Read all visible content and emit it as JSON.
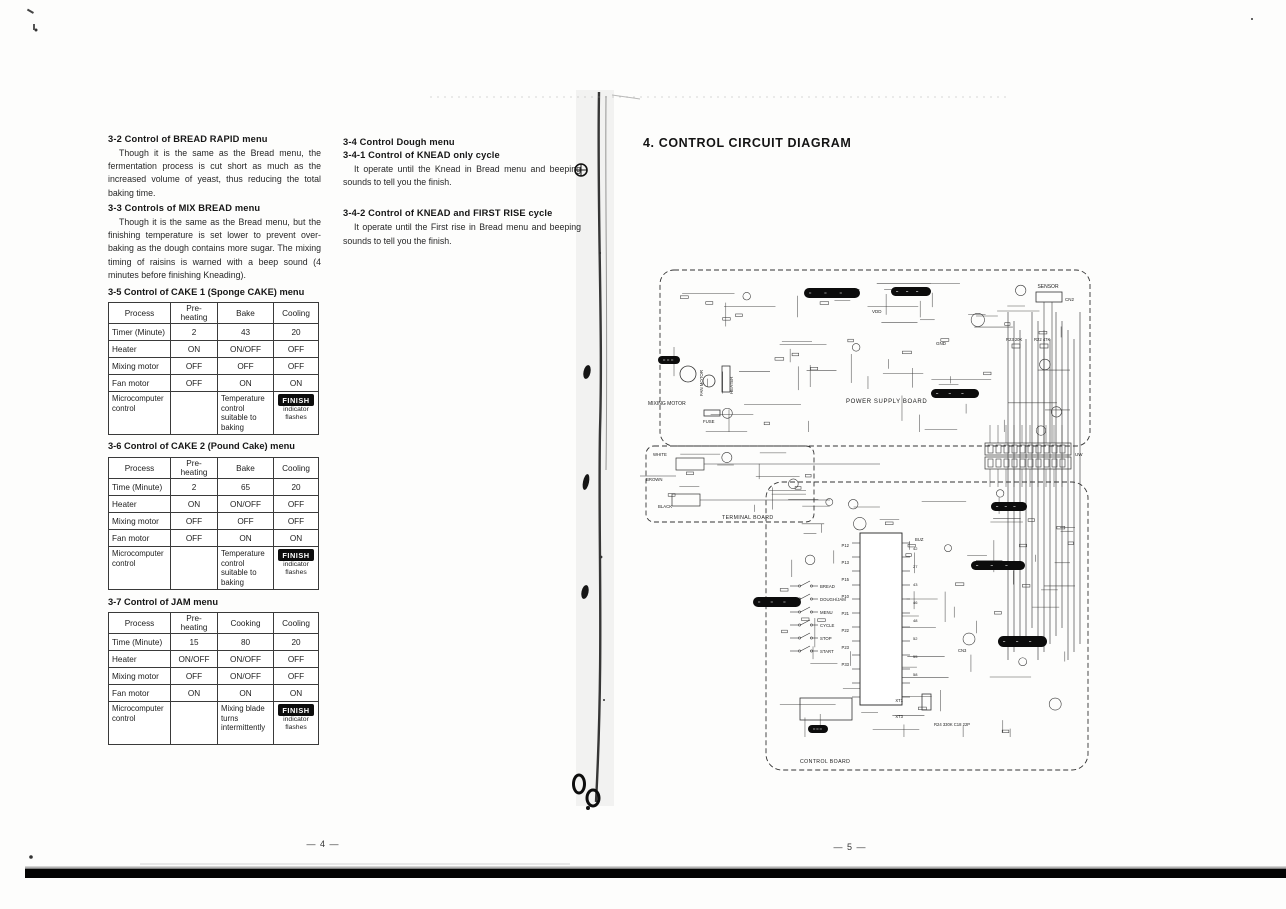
{
  "scan": {
    "page_left_number": "— 4 —",
    "page_right_number": "— 5 —"
  },
  "left": {
    "sections": [
      {
        "heading": "3-2   Control of BREAD RAPID menu",
        "body": "Though it is the same as the Bread menu, the fermentation process is cut short as much as the increased volume of yeast, thus reducing the total baking time."
      },
      {
        "heading": "3-3   Controls of MIX BREAD menu",
        "body": "Though it is the same as the Bread menu, but the finishing temperature is set lower to prevent over-baking as the dough contains more sugar. The mixing timing of raisins is warned with a beep sound (4 minutes before finishing Kneading)."
      }
    ],
    "dough": {
      "heading": "3-4   Control Dough menu",
      "sub1": "3-4-1   Control of KNEAD only cycle",
      "body1": "It operate until the Knead in Bread menu and beeping sounds to tell you the finish.",
      "sub2": "3-4-2   Control of KNEAD and FIRST RISE cycle",
      "body2": "It operate until the First rise in Bread menu and beeping sounds to tell you the finish."
    },
    "tables": [
      {
        "heading": "3-5   Control of CAKE 1 (Sponge CAKE) menu",
        "columns": [
          "Process",
          "Pre-heating",
          "Bake",
          "Cooling"
        ],
        "rows": [
          [
            "Timer (Minute)",
            "2",
            "43",
            "20"
          ],
          [
            "Heater",
            "ON",
            "ON/OFF",
            "OFF"
          ],
          [
            "Mixing motor",
            "OFF",
            "OFF",
            "OFF"
          ],
          [
            "Fan motor",
            "OFF",
            "ON",
            "ON"
          ]
        ],
        "footer": {
          "label": "Microcomputer control",
          "pre": "",
          "note": "Temperature control suitable to baking",
          "finish": "FINISH",
          "finish_note_1": "indicator",
          "finish_note_2": "flashes"
        }
      },
      {
        "heading": "3-6   Control of CAKE 2 (Pound Cake) menu",
        "columns": [
          "Process",
          "Pre-heating",
          "Bake",
          "Cooling"
        ],
        "rows": [
          [
            "Time (Minute)",
            "2",
            "65",
            "20"
          ],
          [
            "Heater",
            "ON",
            "ON/OFF",
            "OFF"
          ],
          [
            "Mixing motor",
            "OFF",
            "OFF",
            "OFF"
          ],
          [
            "Fan motor",
            "OFF",
            "ON",
            "ON"
          ]
        ],
        "footer": {
          "label": "Microcomputer control",
          "pre": "",
          "note": "Temperature control suitable to baking",
          "finish": "FINISH",
          "finish_note_1": "indicator",
          "finish_note_2": "flashes"
        }
      },
      {
        "heading": "3-7   Control of JAM menu",
        "columns": [
          "Process",
          "Pre-heating",
          "Cooking",
          "Cooling"
        ],
        "rows": [
          [
            "Time (Minute)",
            "15",
            "80",
            "20"
          ],
          [
            "Heater",
            "ON/OFF",
            "ON/OFF",
            "OFF"
          ],
          [
            "Mixing motor",
            "OFF",
            "ON/OFF",
            "OFF"
          ],
          [
            "Fan motor",
            "ON",
            "ON",
            "ON"
          ]
        ],
        "footer": {
          "label": "Microcomputer control",
          "pre": "",
          "note": "Mixing blade turns intermittently",
          "finish": "FINISH",
          "finish_note_1": "indicator",
          "finish_note_2": "flashes"
        }
      }
    ]
  },
  "right": {
    "title": "4.  CONTROL CIRCUIT DIAGRAM",
    "diagram": {
      "boards": {
        "power": "POWER SUPPLY BOARD",
        "terminal": "TERMINAL BOARD",
        "control": "CONTROL BOARD"
      },
      "labels": {
        "sensor": "SENSOR",
        "cn2": "CN2",
        "cn3": "CN3",
        "uw": "UW",
        "vdd": "VDD",
        "gnd": "GND",
        "buz": "BUZ",
        "white": "WHITE",
        "brown": "BROWN",
        "black": "BLACK",
        "mixing_motor": "MIXING MOTOR",
        "fan_motor": "FAN MOTOR",
        "heater": "HEATER",
        "fuse": "FUSE",
        "r23": "R23 20K",
        "r22": "R22 47K",
        "r24": "R24 330K  C18 22P",
        "xt1": "XT1",
        "xt3": "XT3"
      },
      "switch_labels": [
        "BREAD",
        "DOUGH/JAM",
        "MENU",
        "CYCLE",
        "STOP",
        "START"
      ],
      "ic_ports_left": [
        "P12",
        "P13",
        "P15",
        "P10",
        "P21",
        "P22",
        "P23",
        "P33"
      ],
      "ic_pins_right": [
        "42",
        "27",
        "43",
        "46",
        "48",
        "52",
        "55",
        "58"
      ]
    }
  }
}
